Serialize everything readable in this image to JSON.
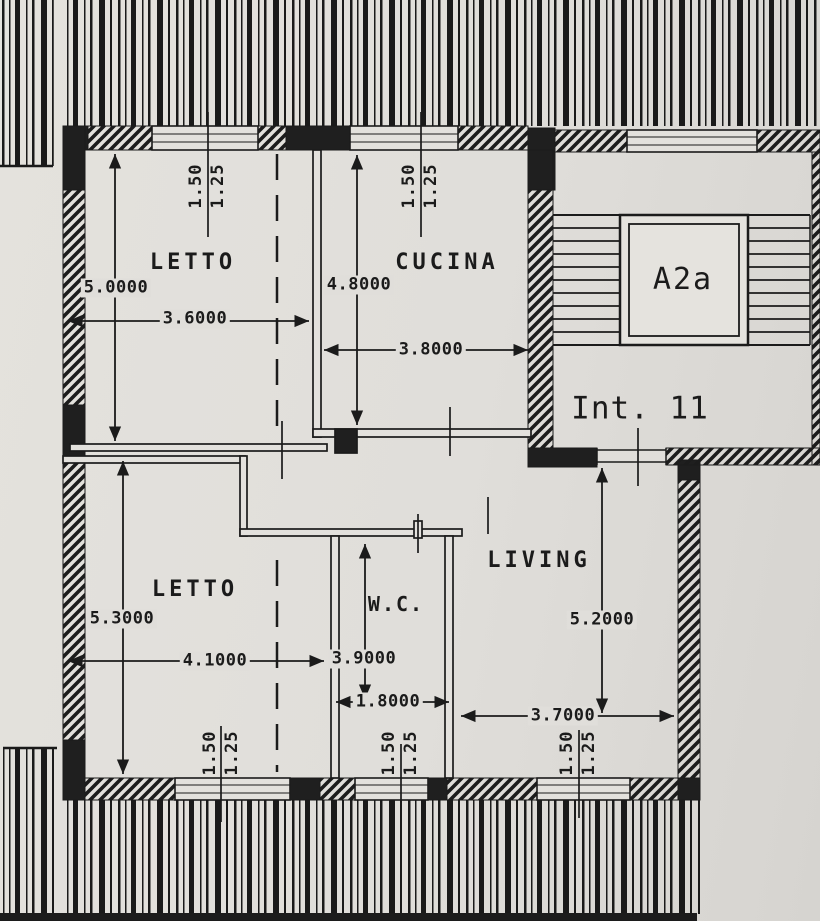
{
  "plan": {
    "unit_label": "Int. 11",
    "stairwell": {
      "elevator_label": "A2a"
    },
    "rooms": [
      {
        "id": "letto-1",
        "name": "LETTO",
        "depth": "5.0000",
        "width": "3.6000",
        "window": {
          "w": "1.50",
          "h": "1.25"
        }
      },
      {
        "id": "cucina",
        "name": "CUCINA",
        "depth": "4.8000",
        "width": "3.8000",
        "window": {
          "w": "1.50",
          "h": "1.25"
        }
      },
      {
        "id": "letto-2",
        "name": "LETTO",
        "depth": "5.3000",
        "width": "4.1000",
        "window": {
          "w": "1.50",
          "h": "1.25"
        }
      },
      {
        "id": "wc",
        "name": "W.C.",
        "depth": "3.9000",
        "width": "1.8000",
        "window": {
          "w": "1.50",
          "h": "1.25"
        }
      },
      {
        "id": "living",
        "name": "LIVING",
        "depth": "5.2000",
        "width": "3.7000",
        "window": {
          "w": "1.50",
          "h": "1.25"
        }
      }
    ],
    "colors": {
      "paper": "#e0deda",
      "ink": "#1b1b1b"
    }
  }
}
